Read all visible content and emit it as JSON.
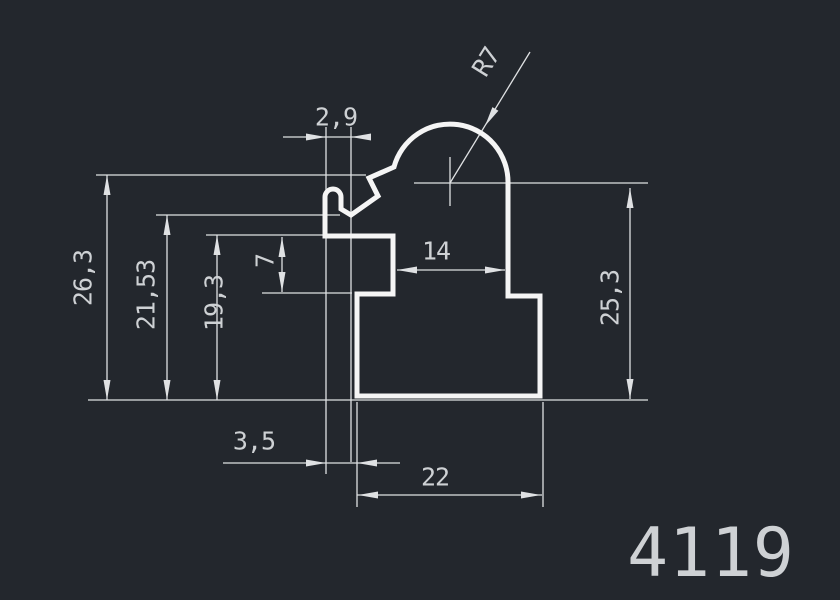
{
  "drawing": {
    "part_label": "4119",
    "dimensions": {
      "hook_opening_width": "2,9",
      "dome_radius": "R7",
      "height_total": "26,3",
      "height_hook_notch": "21,53",
      "height_tab_top": "19,3",
      "tab_height": "7",
      "neck_width": "14",
      "height_right": "25,3",
      "base_left_offset": "3,5",
      "base_width": "22"
    },
    "colors": {
      "background": "#23272d",
      "profile_line": "#f5f5f5",
      "dimension_line": "#dfe1e3",
      "dimension_text": "#ced1d4"
    }
  }
}
